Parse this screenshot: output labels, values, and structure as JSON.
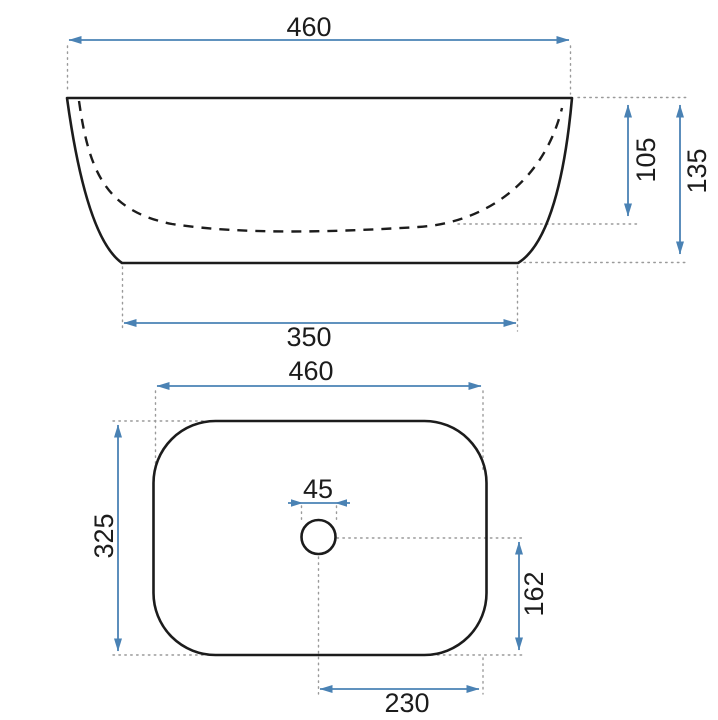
{
  "colors": {
    "dimension_accent": "#4a82b4",
    "outline": "#1c1c1c",
    "extension_gray": "#9a9a9a",
    "background": "#ffffff"
  },
  "side_view": {
    "width": "460",
    "basin_inner_depth": "105",
    "overall_height": "135",
    "base_width": "350"
  },
  "plan_view": {
    "width": "460",
    "depth": "325",
    "drain_diameter": "45",
    "drain_center_to_rear_edge": "162",
    "drain_center_to_side_edge": "230"
  }
}
